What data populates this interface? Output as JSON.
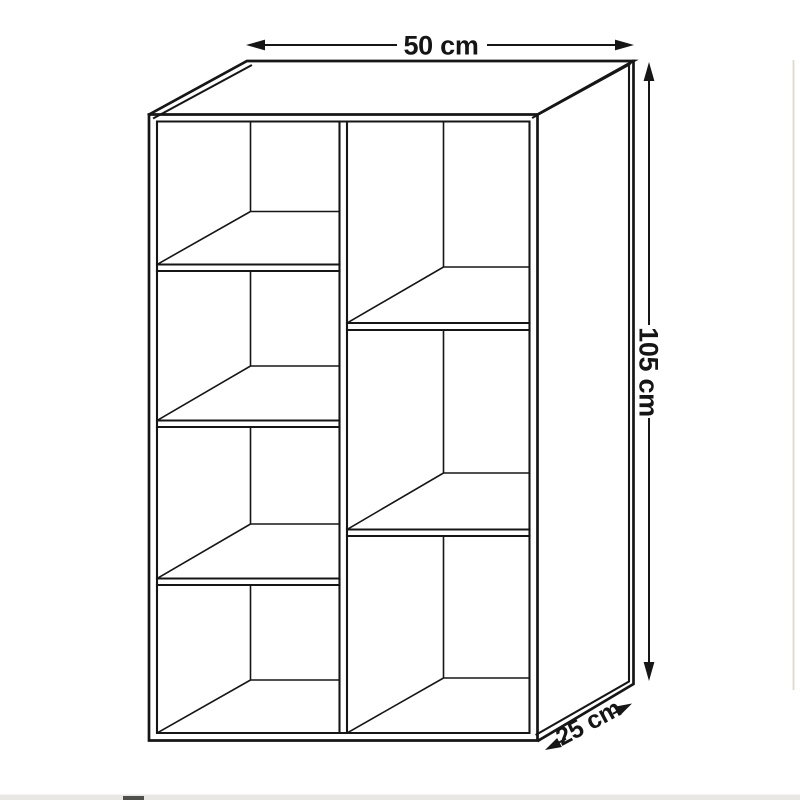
{
  "diagram": {
    "subject": "Bookcase technical dimension drawing",
    "description": "3D line drawing of an open shelving unit with two columns of compartments",
    "compartments": {
      "left_column": 4,
      "right_column": 3,
      "total": 7
    },
    "dimensions": {
      "width": "50 cm",
      "height": "105 cm",
      "depth": "25 cm"
    },
    "colors": {
      "line": "#161616",
      "background": "#ffffff"
    }
  }
}
